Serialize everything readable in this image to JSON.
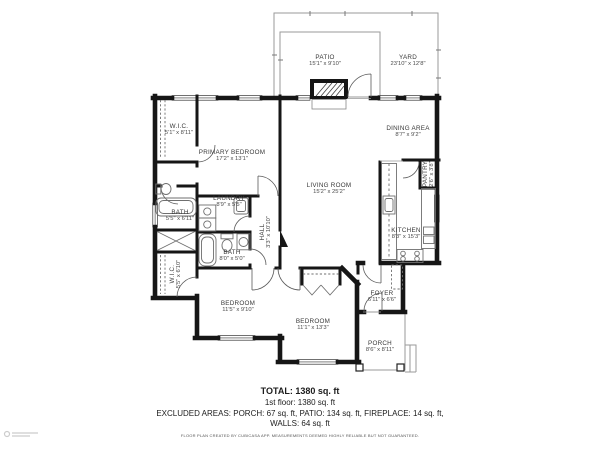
{
  "rooms": [
    {
      "name": "PATIO",
      "dims": "15'1\" x 9'10\""
    },
    {
      "name": "YARD",
      "dims": "23'10\" x 12'8\""
    },
    {
      "name": "W.I.C.",
      "dims": "5'1\" x 8'11\""
    },
    {
      "name": "PRIMARY BEDROOM",
      "dims": "17'2\" x 13'1\""
    },
    {
      "name": "DINING AREA",
      "dims": "8'7\" x 9'2\""
    },
    {
      "name": "LIVING ROOM",
      "dims": "15'2\" x 25'2\""
    },
    {
      "name": "PANTRY",
      "dims": "2'6\" x 3'8\""
    },
    {
      "name": "KITCHEN",
      "dims": "8'3\" x 15'3\""
    },
    {
      "name": "LAUNDRY",
      "dims": "8'9\" x 5'5\""
    },
    {
      "name": "BATH",
      "dims": "5'5\" x 6'11\""
    },
    {
      "name": "HALL",
      "dims": "3'3\" x 10'10\""
    },
    {
      "name": "BATH",
      "dims": "8'0\" x 5'0\""
    },
    {
      "name": "W.I.C.",
      "dims": "5'5\" x 6'10\""
    },
    {
      "name": "BEDROOM",
      "dims": "11'5\" x 9'10\""
    },
    {
      "name": "BEDROOM",
      "dims": "11'1\" x 13'3\""
    },
    {
      "name": "FOYER",
      "dims": "6'11\" x 6'6\""
    },
    {
      "name": "PORCH",
      "dims": "8'6\" x 8'11\""
    }
  ],
  "summary": {
    "total": "TOTAL: 1380 sq. ft",
    "first_floor": "1st floor: 1380 sq. ft",
    "excluded": "EXCLUDED AREAS: PORCH: 67 sq. ft, PATIO: 134 sq. ft, FIREPLACE: 14 sq. ft,",
    "walls": "WALLS: 64 sq. ft",
    "disclaimer": "FLOOR PLAN CREATED BY CUBICASA APP. MEASUREMENTS DEEMED HIGHLY RELIABLE BUT NOT GUARANTEED."
  },
  "colors": {
    "wall": "#161616",
    "outdoor_line": "#9a9a9a",
    "fixture_line": "#6f6f6f",
    "door_arc": "#5a5a5a",
    "label_text": "#3d3d3d"
  }
}
